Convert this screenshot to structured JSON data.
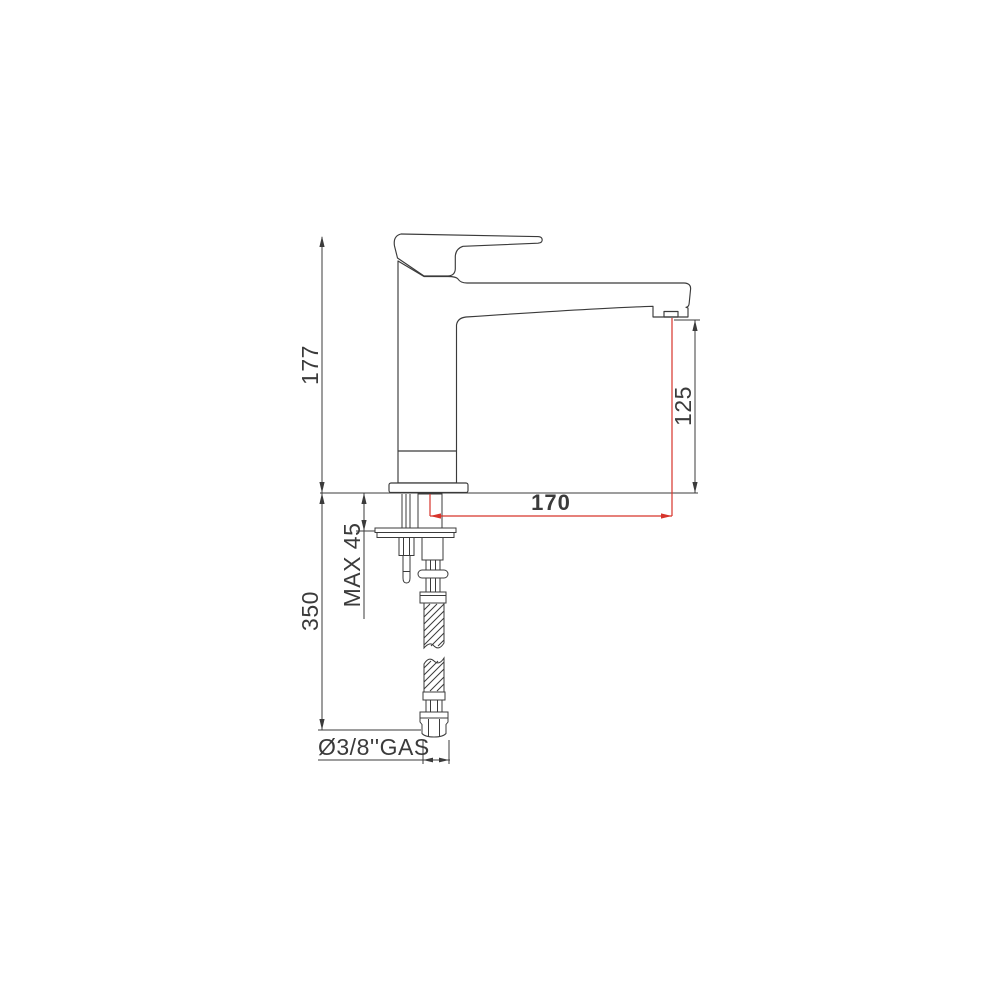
{
  "drawing": {
    "labels": {
      "total_height": "177",
      "spout_height": "125",
      "spout_reach": "170",
      "max_counter_thickness": "MAX 45",
      "under_counter_length": "350",
      "connection_size": "Ø3/8''GAS"
    },
    "colors": {
      "line": "#3b3b3b",
      "accent": "#d7342b",
      "background": "#ffffff"
    }
  }
}
